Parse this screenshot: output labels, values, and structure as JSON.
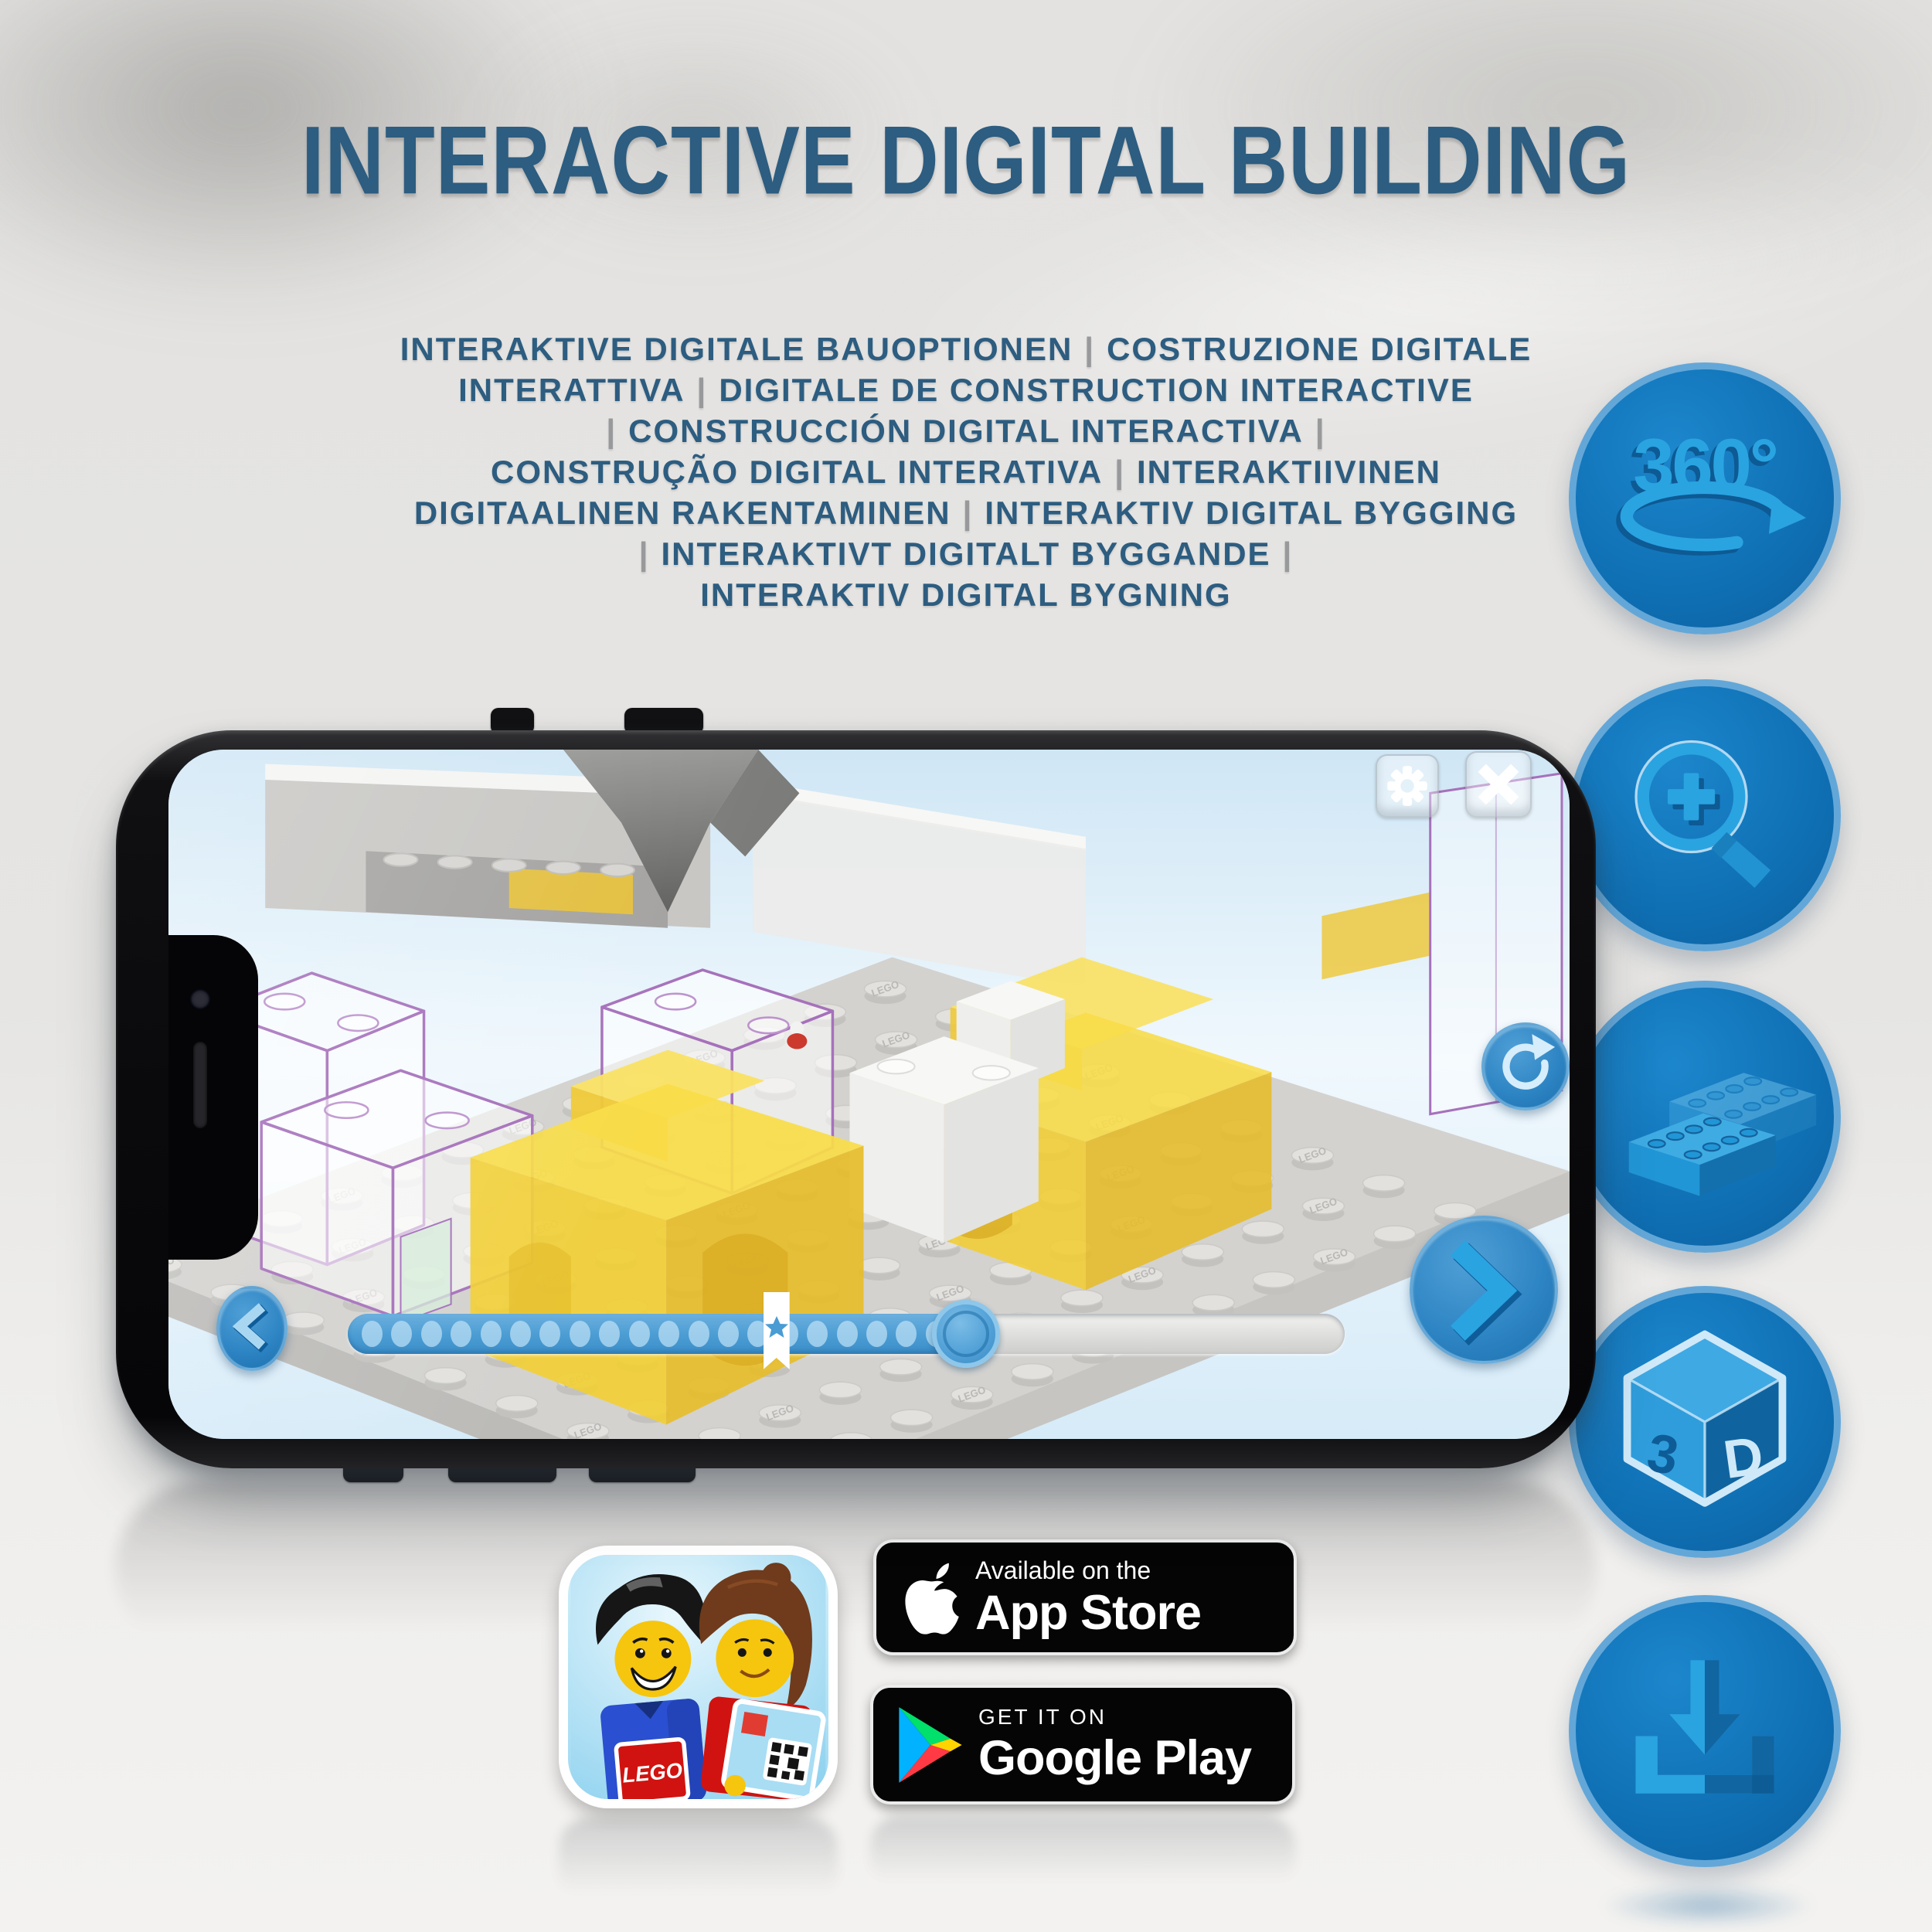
{
  "title": "INTERACTIVE DIGITAL BUILDING",
  "subtitle": {
    "lines": [
      "INTERAKTIVE DIGITALE BAUOPTIONEN | COSTRUZIONE DIGITALE",
      "INTERATTIVA | DIGITALE DE CONSTRUCTION INTERACTIVE",
      "| CONSTRUCCIÓN DIGITAL INTERACTIVA |",
      "CONSTRUÇÃO DIGITAL INTERATIVA | INTERAKTIIVINEN",
      "DIGITAALINEN RAKENTAMINEN | INTERAKTIV DIGITAL BYGGING",
      "| INTERAKTIVT DIGITALT BYGGANDE |",
      "INTERAKTIV DIGITAL BYGNING"
    ]
  },
  "features": [
    {
      "id": "rotate-360",
      "label": "360°"
    },
    {
      "id": "zoom-in"
    },
    {
      "id": "building-brick"
    },
    {
      "id": "3d-view",
      "label_left": "3",
      "label_right": "D"
    },
    {
      "id": "download"
    }
  ],
  "phone": {
    "app": {
      "stud_label": "LEGO",
      "slider": {
        "progress_percent": 62,
        "bookmark_percent": 43,
        "dot_count": 20
      }
    }
  },
  "badges": {
    "lego_app": {
      "logo": "LEGO"
    },
    "app_store": {
      "tagline": "Available on the",
      "store": "App Store"
    },
    "google_play": {
      "tagline": "GET IT ON",
      "store": "Google Play"
    }
  },
  "colors": {
    "title_blue": "#2d5d80",
    "pipe_gray": "#97999b",
    "circle_fill": "#0f6fb3",
    "circle_border": "#63a7d8",
    "glyph_blue": "#2aa3e1",
    "glyph_dark": "#0d5a94",
    "glyph_pale": "#cfe9f9",
    "app_ui_blue": "#4a9cd3",
    "badge_bg": "#050505"
  }
}
